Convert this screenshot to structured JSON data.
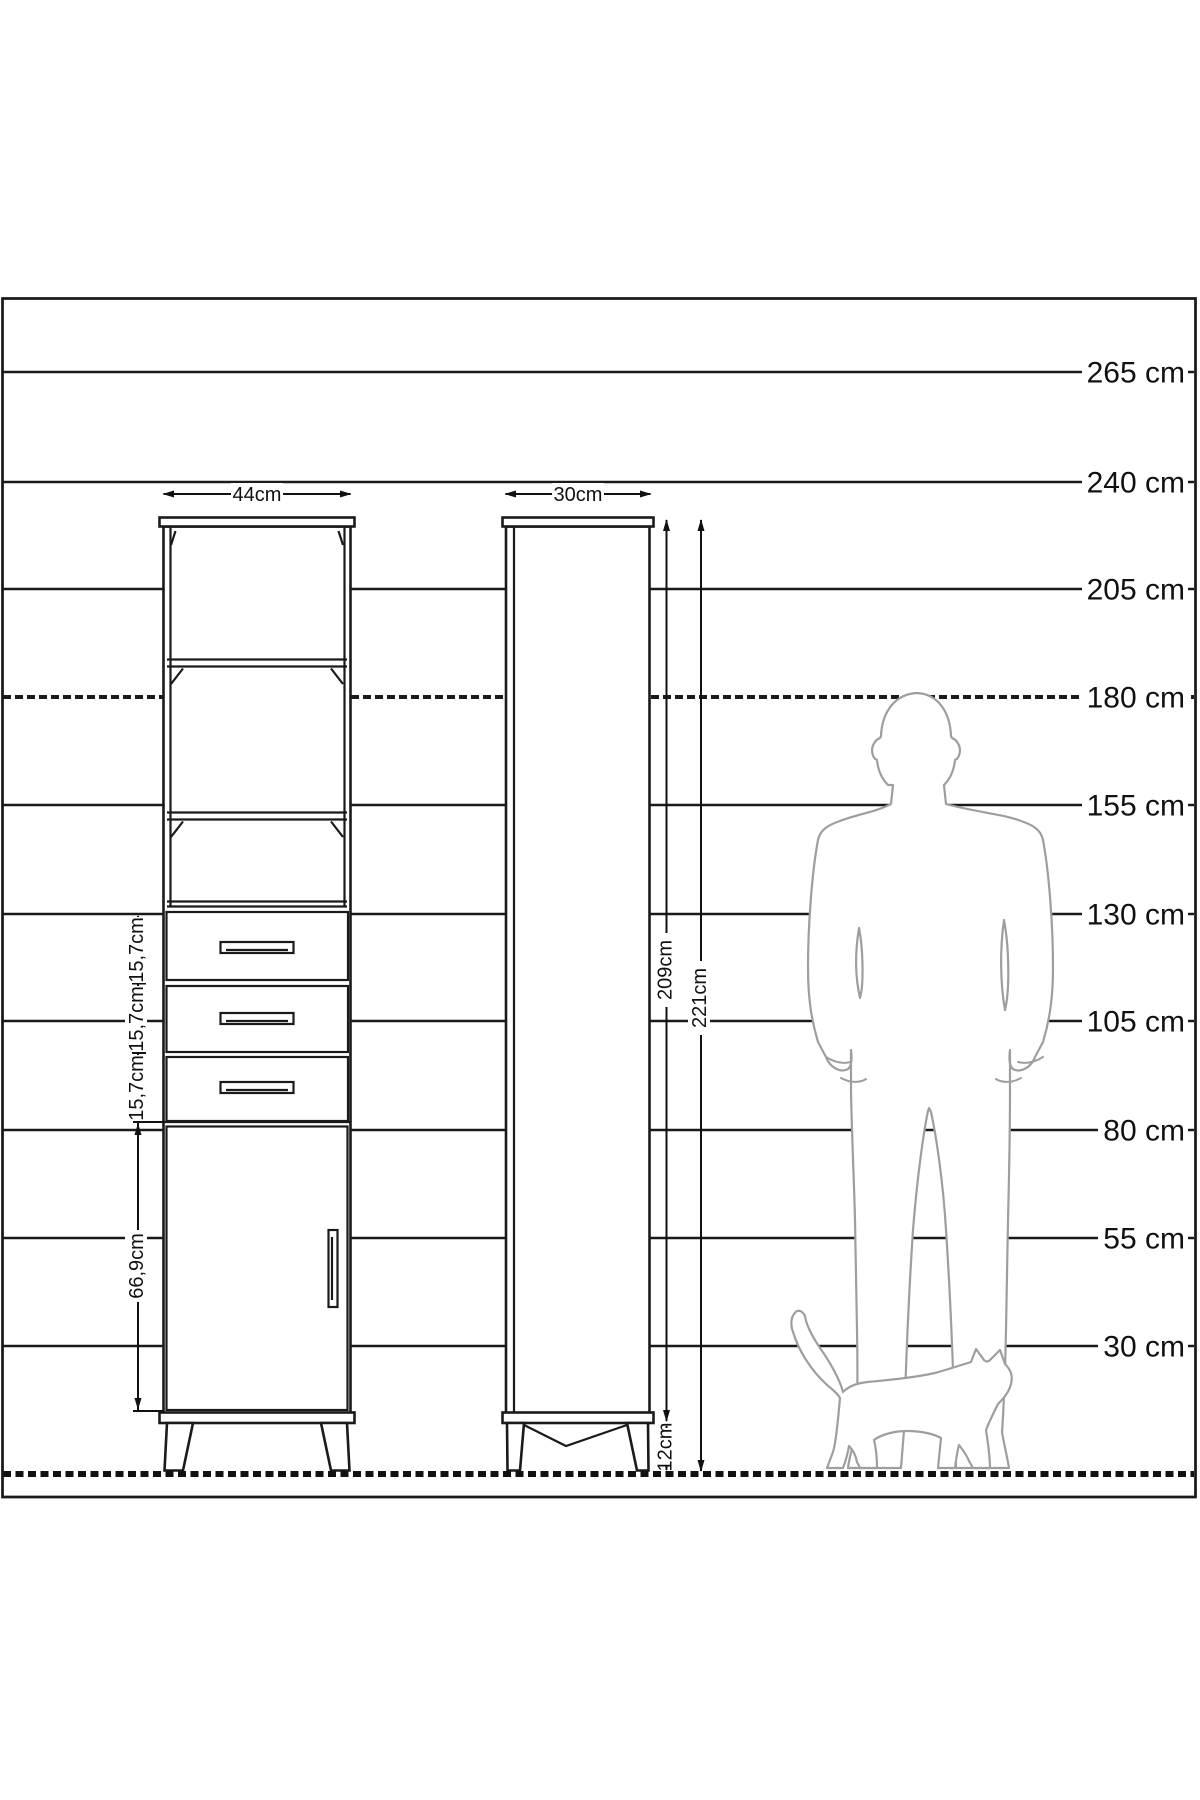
{
  "title": "Cabinet height comparison technical drawing",
  "ruler": {
    "unit": "cm",
    "labels": [
      "265 cm",
      "240 cm",
      "205 cm",
      "180 cm",
      "155 cm",
      "130 cm",
      "105 cm",
      "80 cm",
      "55 cm",
      "30 cm"
    ]
  },
  "dimensions": {
    "front_width": "44cm",
    "side_depth": "30cm",
    "body_height": "209cm",
    "total_height": "221cm",
    "leg_height": "12cm",
    "drawer1_height": "15,7cm",
    "drawer2_height": "15,7cm",
    "drawer3_height": "15,7cm",
    "door_height": "66,9cm"
  },
  "colors": {
    "background": "#ffffff",
    "drawing_line": "#1a1a1a",
    "figure_outline": "#9e9e9e"
  }
}
